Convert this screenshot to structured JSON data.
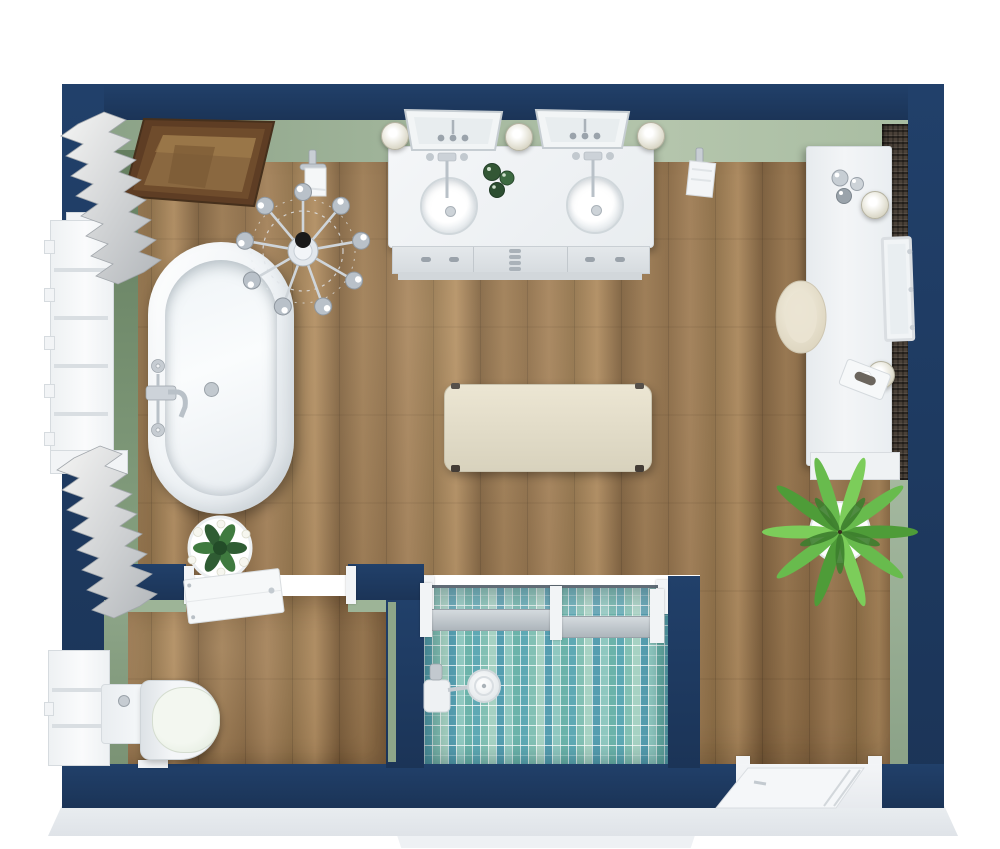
{
  "scene": {
    "type": "3d-floor-plan-render",
    "room": "bathroom",
    "view": "top-down"
  },
  "palette": {
    "wall_navy": "#21406a",
    "wall_navy_deep": "#1b3457",
    "green_face": "#9db497",
    "wood_base": "#9a7850",
    "tile_mid": "#6fb3ae",
    "fixture_white": "#f2f4f6",
    "fixture_border": "#d6dbdf",
    "backsplash": "#4a4138",
    "chrome": "#c6ccd3",
    "cream": "#e9e4d2",
    "frame_brown": "#5e3d24",
    "plant_green": "#5aa83c",
    "bevel_gray": "#e6eaee"
  },
  "rooms": [
    {
      "name": "main-bathroom",
      "floor": "wood-plank"
    },
    {
      "name": "water-closet",
      "floor": "wood-plank"
    },
    {
      "name": "shower-room",
      "floor": "teal-mosaic-tile"
    }
  ],
  "objects": [
    {
      "name": "freestanding-bathtub",
      "category": "fixture",
      "color": "white"
    },
    {
      "name": "tub-faucet",
      "category": "fixture",
      "color": "chrome"
    },
    {
      "name": "crystal-chandelier",
      "category": "lighting",
      "color": "chrome"
    },
    {
      "name": "wood-framed-mirror",
      "category": "decor",
      "color": "dark-wood"
    },
    {
      "name": "double-sink-vanity",
      "category": "furniture",
      "color": "white"
    },
    {
      "name": "vanity-mirror-left",
      "category": "decor"
    },
    {
      "name": "vanity-mirror-right",
      "category": "decor"
    },
    {
      "name": "wall-sconces",
      "category": "lighting",
      "count": 5
    },
    {
      "name": "toilet-paper-holder",
      "category": "accessory"
    },
    {
      "name": "towel-hook",
      "category": "accessory"
    },
    {
      "name": "window-main",
      "category": "architecture"
    },
    {
      "name": "window-wc",
      "category": "architecture"
    },
    {
      "name": "pleated-curtains",
      "category": "decor",
      "count": 2
    },
    {
      "name": "upholstered-bench",
      "category": "furniture",
      "color": "cream"
    },
    {
      "name": "dressing-counter",
      "category": "furniture",
      "color": "white-quartz"
    },
    {
      "name": "dark-stone-backsplash",
      "category": "architecture"
    },
    {
      "name": "perfume-bottles",
      "category": "decor"
    },
    {
      "name": "leaning-mirror",
      "category": "decor"
    },
    {
      "name": "tissue-box",
      "category": "decor"
    },
    {
      "name": "vanity-stool",
      "category": "furniture",
      "color": "cream"
    },
    {
      "name": "palm-plant",
      "category": "plant"
    },
    {
      "name": "flower-plant",
      "category": "plant"
    },
    {
      "name": "wc-door",
      "category": "architecture",
      "state": "open"
    },
    {
      "name": "toilet",
      "category": "fixture",
      "color": "white"
    },
    {
      "name": "shower-glass-partition",
      "category": "architecture"
    },
    {
      "name": "shower-head",
      "category": "fixture",
      "color": "chrome"
    },
    {
      "name": "entry-door",
      "category": "architecture",
      "state": "open"
    },
    {
      "name": "amenity-bottles-green",
      "category": "decor"
    }
  ]
}
